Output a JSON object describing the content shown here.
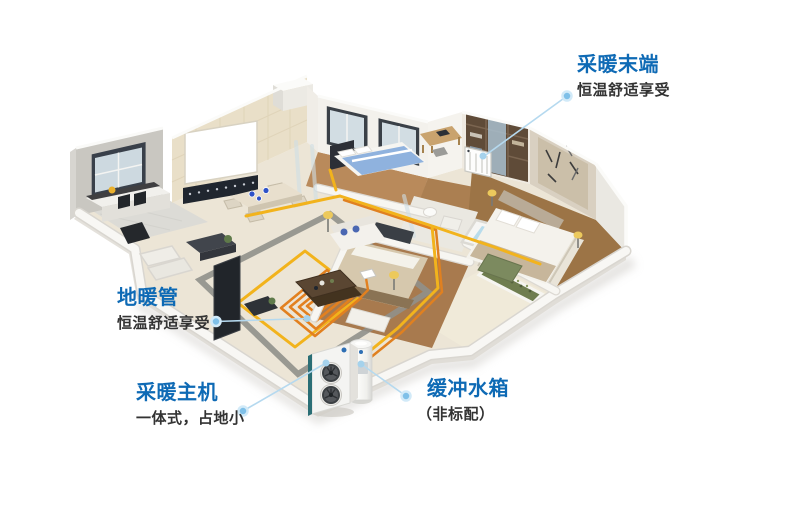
{
  "page": {
    "width": 800,
    "height": 516,
    "background": "#ffffff",
    "language": "zh-CN"
  },
  "style": {
    "title_color": "#0e6ab5",
    "subtitle_color": "#333333",
    "leader_line_color": "#b5d9ef",
    "dot_color": "#7fc0e8",
    "pipe_yellow": "#f2b31c",
    "pipe_orange": "#e08020",
    "coil_orange": "#e2801f",
    "wall_white": "#f3f1ec",
    "floor_cream": "#ece5d6",
    "wood_floor": "#a57a4d",
    "tub_water": "#b8dcec"
  },
  "callouts": [
    {
      "id": "heating-terminal",
      "title": "采暖末端",
      "subtitle": "恒温舒适享受",
      "target": "wall-radiator"
    },
    {
      "id": "floor-heating-pipe",
      "title": "地暖管",
      "subtitle": "恒温舒适享受",
      "target": "floor-heating-coil"
    },
    {
      "id": "heating-host",
      "title": "采暖主机",
      "subtitle": "一体式，占地小",
      "target": "heat-pump-outdoor-unit"
    },
    {
      "id": "buffer-tank",
      "title": "缓冲水箱",
      "subtitle": "（非标配）",
      "target": "buffer-water-tank"
    }
  ],
  "scene": {
    "type": "isometric-cutaway-apartment",
    "elements": [
      "kitchen",
      "dining-area",
      "living-room",
      "master-bedroom",
      "second-bedroom",
      "third-bedroom",
      "bathroom",
      "terrace",
      "balcony",
      "projection-screen",
      "balustrade",
      "tv-panel",
      "sofa",
      "coffee-table",
      "dining-table",
      "bathtub",
      "planter",
      "rug",
      "wardrobe",
      "floor-heating-coil",
      "heating-pipes",
      "wall-radiator",
      "heat-pump-outdoor-unit",
      "buffer-water-tank"
    ]
  }
}
